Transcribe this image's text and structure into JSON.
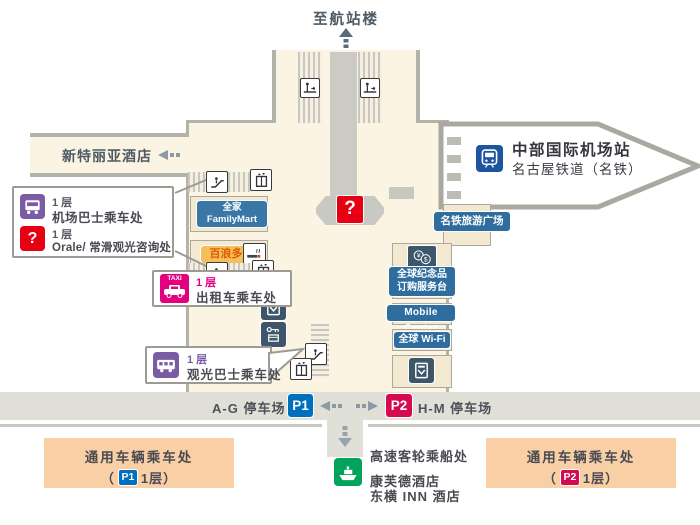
{
  "colors": {
    "building_fill": "#FBF4E3",
    "building_border": "#B3B3AA",
    "road": "#E0E0D9",
    "unit_fill": "#F3E9D1",
    "label_blue": "#2E6D9D",
    "familymart_blue": "#3B77A6",
    "dark_slate": "#3E5669",
    "purple": "#7A5CA5",
    "red": "#E60012",
    "pink": "#E3007F",
    "p1_blue": "#0070BE",
    "p2_crimson": "#D60A50",
    "green": "#00A45A",
    "peach": "#F9CFA5",
    "pronto_yellow": "#F5C05B",
    "pronto_text": "#E05A00",
    "train_blue": "#1D55A0"
  },
  "icons": {
    "train": "train-icon",
    "escalator": "escalator-icon",
    "elevator": "elevator-icon",
    "moving_walkway": "moving-walkway-icon",
    "toilet": "toilet-icon",
    "smoking": "smoking-area-icon",
    "atm": "atm-icon",
    "coin_locker": "coin-locker-icon",
    "currency_exchange": "currency-exchange-icon",
    "information": "information-icon",
    "airport_bus": "bus-icon",
    "taxi": "taxi-icon",
    "sightseeing_bus": "bus-side-icon",
    "ship": "ferry-icon"
  },
  "top": {
    "to_terminal": "至航站楼"
  },
  "west_wing": {
    "hotel_label": "新特丽亚酒店"
  },
  "station": {
    "name": "中部国际机场站",
    "operator": "名古屋铁道（名铁）"
  },
  "shops": {
    "familymart_line1": "全家",
    "familymart_line2": "FamilyMart",
    "pronto": "百浪多",
    "meitetsu_plaza": "名铁旅游广场",
    "souvenir_line1": "全球纪念品",
    "souvenir_line2": "订购服务台",
    "mobile_center": "Mobile Center",
    "global_wifi": "全球 Wi-Fi"
  },
  "info": {
    "mark": "?"
  },
  "callouts": {
    "airport_bus": {
      "floor": "1 层",
      "name": "机场巴士乘车处"
    },
    "orale": {
      "floor": "1 层",
      "name": "Orale/ 常滑观光咨询处",
      "mark": "?"
    },
    "taxi": {
      "floor": "1 层",
      "name": "出租车乘车处",
      "sign": "TAXI"
    },
    "sightseeing_bus": {
      "floor": "1 层",
      "name": "观光巴士乘车处"
    }
  },
  "parking": {
    "p1_badge": "P1",
    "p1_label": "A-G 停车场",
    "p2_badge": "P2",
    "p2_label": "H-M 停车场",
    "general_label": "通用车辆乘车处",
    "floor_pre": "（",
    "floor_post": "1层）"
  },
  "south": {
    "ferry": "高速客轮乘船处",
    "hotel1": "康芙德酒店",
    "hotel2": "东横 INN 酒店"
  }
}
